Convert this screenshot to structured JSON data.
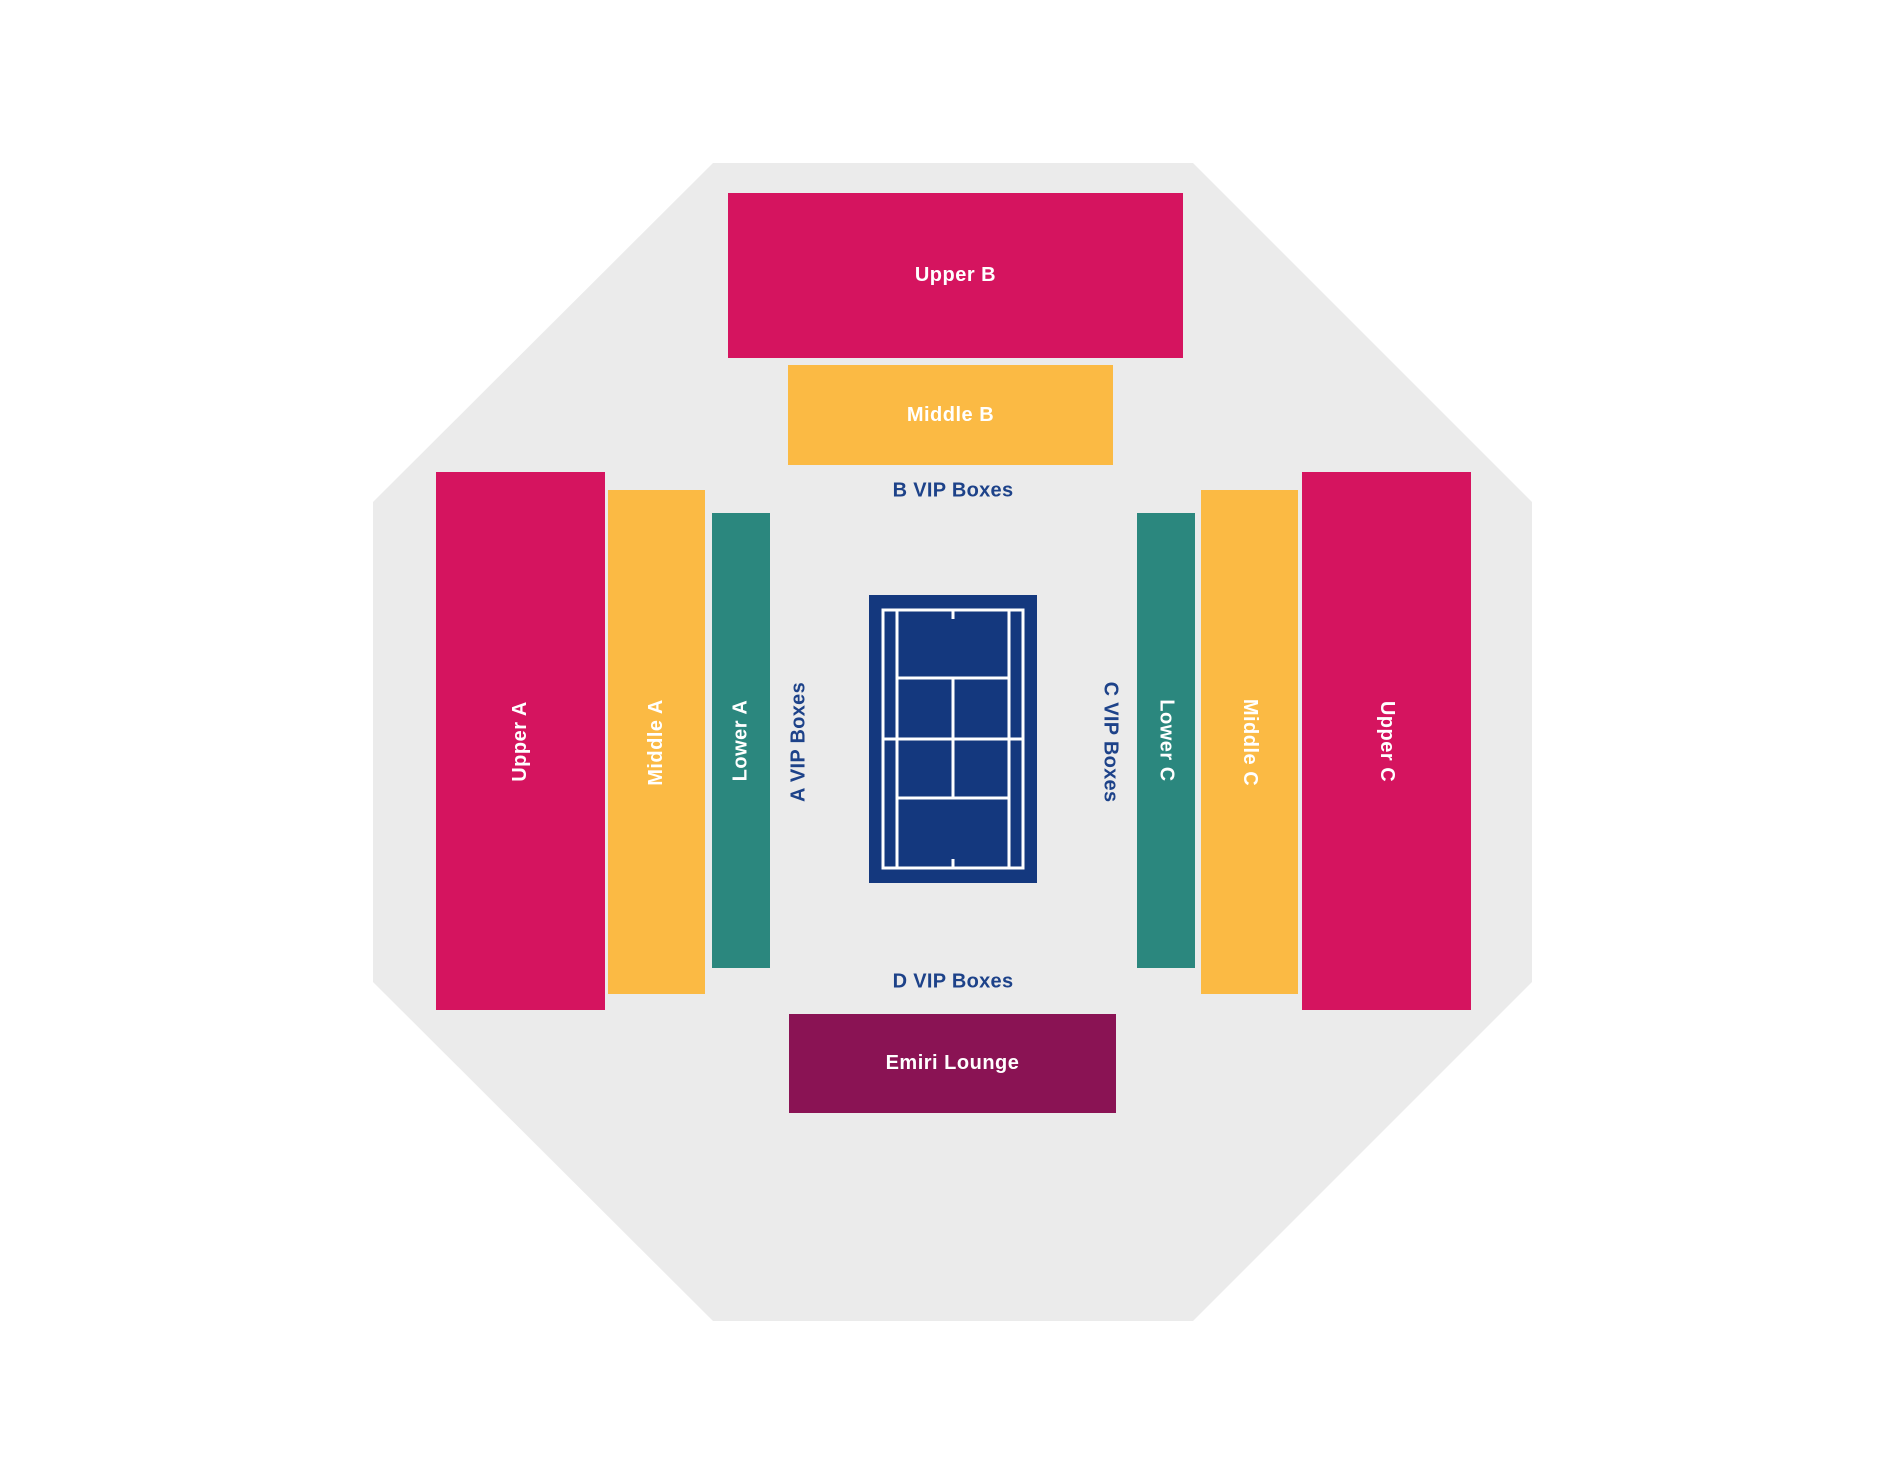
{
  "map": {
    "name": "tennis-stadium-seating-map"
  },
  "colors": {
    "background": "#ffffff",
    "octagon": "#ebebeb",
    "crimson": "#d5145f",
    "orange": "#fbba44",
    "teal": "#2b877e",
    "maroon": "#8a1354",
    "court_navy": "#14387e",
    "court_lines": "#ffffff",
    "label_text": "#ffffff",
    "vip_text": "#1d4289"
  },
  "sections": {
    "upper_b": {
      "label": "Upper B",
      "tier": "upper",
      "color": "#d5145f"
    },
    "middle_b": {
      "label": "Middle B",
      "tier": "middle",
      "color": "#fbba44"
    },
    "upper_a": {
      "label": "Upper A",
      "tier": "upper",
      "color": "#d5145f"
    },
    "middle_a": {
      "label": "Middle A",
      "tier": "middle",
      "color": "#fbba44"
    },
    "lower_a": {
      "label": "Lower A",
      "tier": "lower",
      "color": "#2b877e"
    },
    "lower_c": {
      "label": "Lower C",
      "tier": "lower",
      "color": "#2b877e"
    },
    "middle_c": {
      "label": "Middle C",
      "tier": "middle",
      "color": "#fbba44"
    },
    "upper_c": {
      "label": "Upper C",
      "tier": "upper",
      "color": "#d5145f"
    },
    "emiri_lounge": {
      "label": "Emiri Lounge",
      "tier": "lounge",
      "color": "#8a1354"
    }
  },
  "vip_labels": {
    "a": "A VIP Boxes",
    "b": "B VIP Boxes",
    "c": "C VIP Boxes",
    "d": "D VIP Boxes"
  },
  "court": {
    "name": "tennis-court"
  }
}
